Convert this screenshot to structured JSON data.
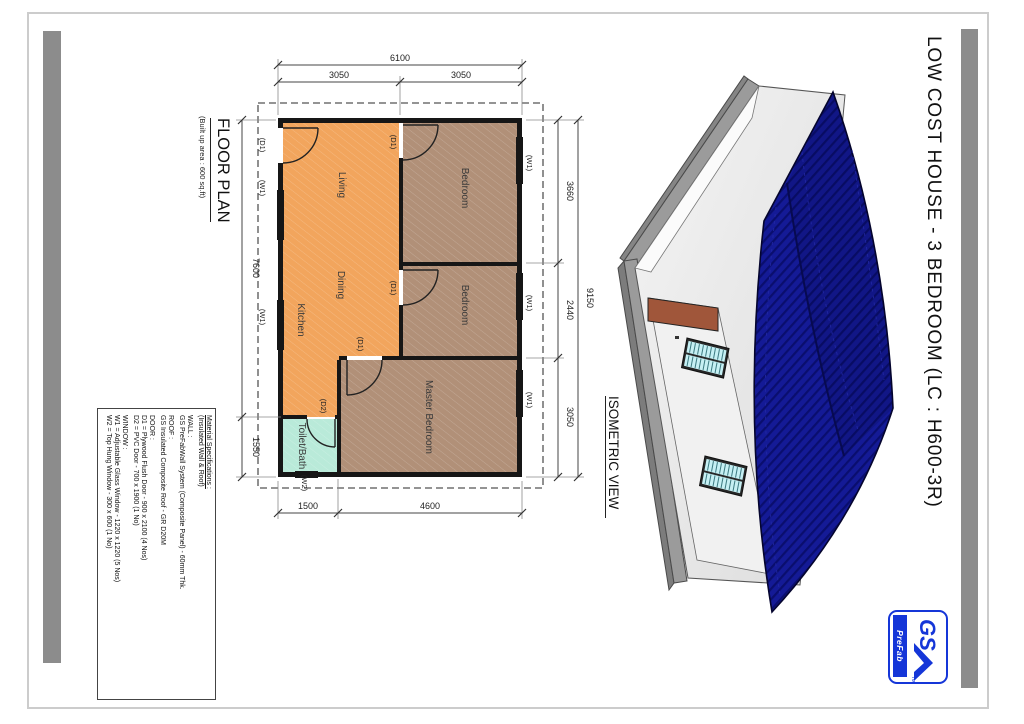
{
  "page": {
    "title": "LOW COST HOUSE - 3 BEDROOM (LC : H600-3R)"
  },
  "floor_plan": {
    "title": "FLOOR PLAN",
    "subtitle": "(Built up area : 600 sq.ft)",
    "rooms": {
      "living": "Living",
      "dining": "Dining",
      "kitchen": "Kitchen",
      "bedroom1": "Bedroom",
      "bedroom2": "Bedroom",
      "master": "Master Bedroom",
      "toilet": "Toilet/Bath"
    },
    "tags": {
      "d1": "(D1)",
      "d2": "(D2)",
      "w1": "(W1)",
      "w2": "(W2)"
    },
    "dims": {
      "top_total": "6100",
      "top_a": "3050",
      "top_b": "3050",
      "right_total": "9150",
      "right_a": "3660",
      "right_b": "2440",
      "right_c": "3050",
      "left_a": "7600",
      "left_b": "1550",
      "bottom_a": "1500",
      "bottom_b": "4600"
    }
  },
  "isometric": {
    "title": "ISOMETRIC VIEW"
  },
  "specs": {
    "lines": [
      "Material Specifications :",
      "(Insulated Wall & Roof)",
      "WALL :",
      "GS PreFabWall System (Composite Panel) - 60mm Thk.",
      "ROOF :",
      "GS Insulated Composite Roof - GR D20M",
      "DOOR :",
      "D1 = Plywood Flush Door - 900 x 2100 (4 Nos)",
      "D2 = PVC Door - 700 x 1900 (1 No)",
      "WINDOW :",
      "W1 = Adjustable Glass Window - 1220 x 1220 (5 Nos)",
      "W2 = Top Hung Window - 300 x 600 (1 No)"
    ]
  },
  "logo": {
    "gs": "GS",
    "prefab": "PreFab",
    "tm": "TM"
  },
  "colors": {
    "roof_blue": "#141a96",
    "open_plan_orange": "#f2a55d",
    "bedroom_tan": "#b19078",
    "toilet_cyan": "#b9ead9",
    "logo_blue": "#1536d8",
    "slab_gray": "#9b9b9b"
  }
}
